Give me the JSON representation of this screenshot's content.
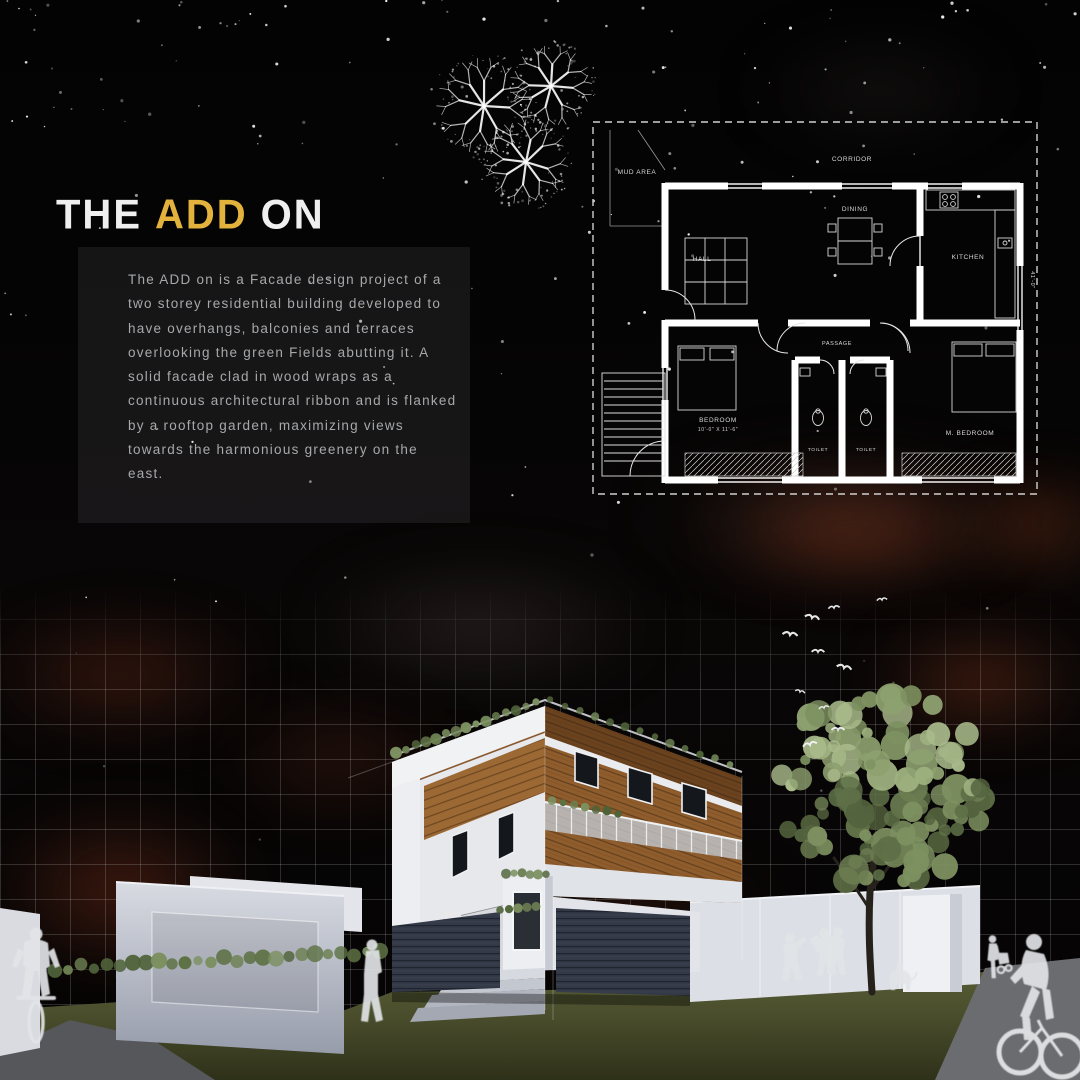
{
  "title": {
    "prefix": "THE",
    "accent": "ADD",
    "suffix": "ON"
  },
  "description": "The ADD on is a Facade design project of a two storey residential building developed to have overhangs, balconies and terraces overlooking the green Fields abutting it. A solid facade clad in wood wraps as a continuous architectural ribbon and is flanked by a rooftop garden, maximizing views towards the harmonious greenery on the east.",
  "floor_plan": {
    "labels": {
      "mud_area": "MUD AREA",
      "corridor": "CORRIDOR",
      "hall": "HALL",
      "dining": "DINING",
      "kitchen": "KITCHEN",
      "passage": "PASSAGE",
      "bedroom": "BEDROOM",
      "bedroom_dim": "10'-0\" X 11'-6\"",
      "toilet_a": "TOILET",
      "toilet_b": "TOILET",
      "master_bedroom": "M. BEDROOM",
      "right_dim": "41'-0\""
    }
  },
  "colors": {
    "accent_yellow": "#e3b23c",
    "wood": "#8f5c2c",
    "cloud_red": "#7a3a20",
    "grass_olive": "#4f5430",
    "silhouette_white": "#e2e4e7",
    "plan_line": "#ffffff"
  }
}
